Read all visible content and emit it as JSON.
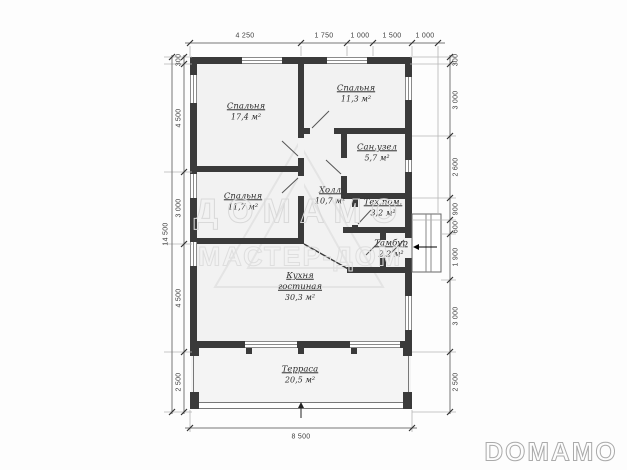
{
  "plan": {
    "rooms": [
      {
        "name": "Спальня",
        "area": "17,4 м²"
      },
      {
        "name": "Спальня",
        "area": "11,3 м²"
      },
      {
        "name": "Сан.узел",
        "area": "5,7 м²"
      },
      {
        "name": "Спальня",
        "area": "11,7 м²"
      },
      {
        "name": "Холл",
        "area": "10,7 м²"
      },
      {
        "name": "Тех.пом.",
        "area": "3,2 м²"
      },
      {
        "name": "Тамбур",
        "area": "2,2 м²"
      },
      {
        "name": "Кухня",
        "name2": "гостиная",
        "area": "30,3 м²"
      },
      {
        "name": "Терраса",
        "area": "20,5 м²"
      }
    ]
  },
  "dimensions": {
    "top": [
      "4 250",
      "1 750",
      "1 000",
      "1 500",
      "1 000"
    ],
    "left_total": "14 500",
    "left": [
      "300",
      "4 500",
      "3 000",
      "4 500",
      "2 500"
    ],
    "right": [
      "300",
      "3 000",
      "2 600",
      "900",
      "600",
      "1 900",
      "3 000",
      "2 500"
    ],
    "bottom": "8 500"
  },
  "watermark": {
    "brand": "ДОМАМО",
    "sub": "МАСТЕР-ДОМ"
  },
  "footer_logo": "DOMAMO",
  "colors": {
    "wall": "#3a3a3a",
    "floor": "#f2f2f2",
    "dimension": "#3d3d3d",
    "watermark": "#d9d9d9"
  }
}
